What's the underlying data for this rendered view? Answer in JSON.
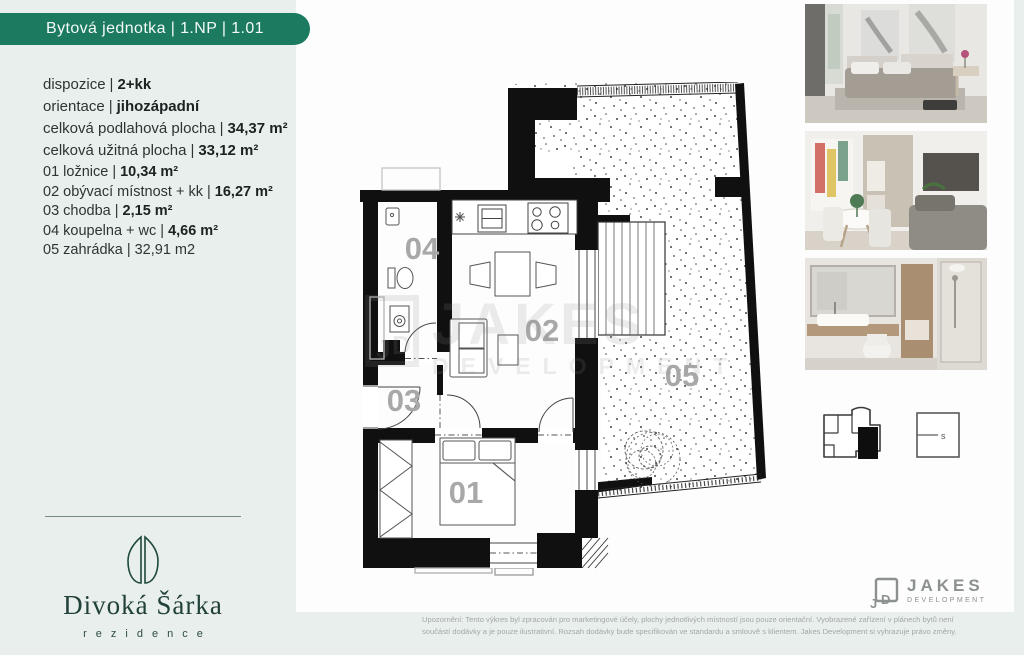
{
  "header": {
    "title": "Bytová jednotka | 1.NP | 1.01"
  },
  "sep": "|",
  "specs": [
    {
      "label": "dispozice",
      "value": "2+kk"
    },
    {
      "label": "orientace",
      "value": "jihozápadní"
    },
    {
      "label": "celková podlahová plocha",
      "value": "34,37 m²"
    },
    {
      "label": "celková užitná plocha",
      "value": "33,12 m²"
    }
  ],
  "rooms": [
    {
      "num": "01",
      "name": "ložnice",
      "area": "10,34 m²"
    },
    {
      "num": "02",
      "name": "obývací místnost + kk",
      "area": "16,27 m²"
    },
    {
      "num": "03",
      "name": "chodba",
      "area": "2,15 m²"
    },
    {
      "num": "04",
      "name": "koupelna + wc",
      "area": "4,66 m²"
    },
    {
      "num": "05",
      "name": "zahrádka",
      "area": "32,91 m2"
    }
  ],
  "brand": {
    "name": "Divoká Šárka",
    "subtitle": "rezidence"
  },
  "developer": {
    "name": "JAKES",
    "subtitle": "DEVELOPMENT",
    "monogram_j": "J",
    "monogram_d": "D"
  },
  "watermark": {
    "line1": "JAKES",
    "line2": "DEVELOPMENT",
    "mono_j": "J",
    "mono_d": "D"
  },
  "thumbnails": {
    "site_label": "s"
  },
  "photos": [
    {
      "label": "bedroom visualization"
    },
    {
      "label": "living room visualization"
    },
    {
      "label": "bathroom visualization"
    }
  ],
  "disclaimer": {
    "line1": "Upozornění: Tento výkres byl zpracován pro marketingové účely, plochy jednotlivých místností jsou pouze orientační. Vyobrazené zařízení v plánech bytů není",
    "line2": "součástí dodávky a je pouze ilustrativní. Rozsah dodávky bude specifikován ve standardu a smlouvě s klientem. Jakes Development si vyhrazuje právo změny."
  },
  "colors": {
    "banner_green": "#1b7a60",
    "brand_green": "#21413a",
    "wall_black": "#101010",
    "label_gray": "#a8a8a8"
  }
}
